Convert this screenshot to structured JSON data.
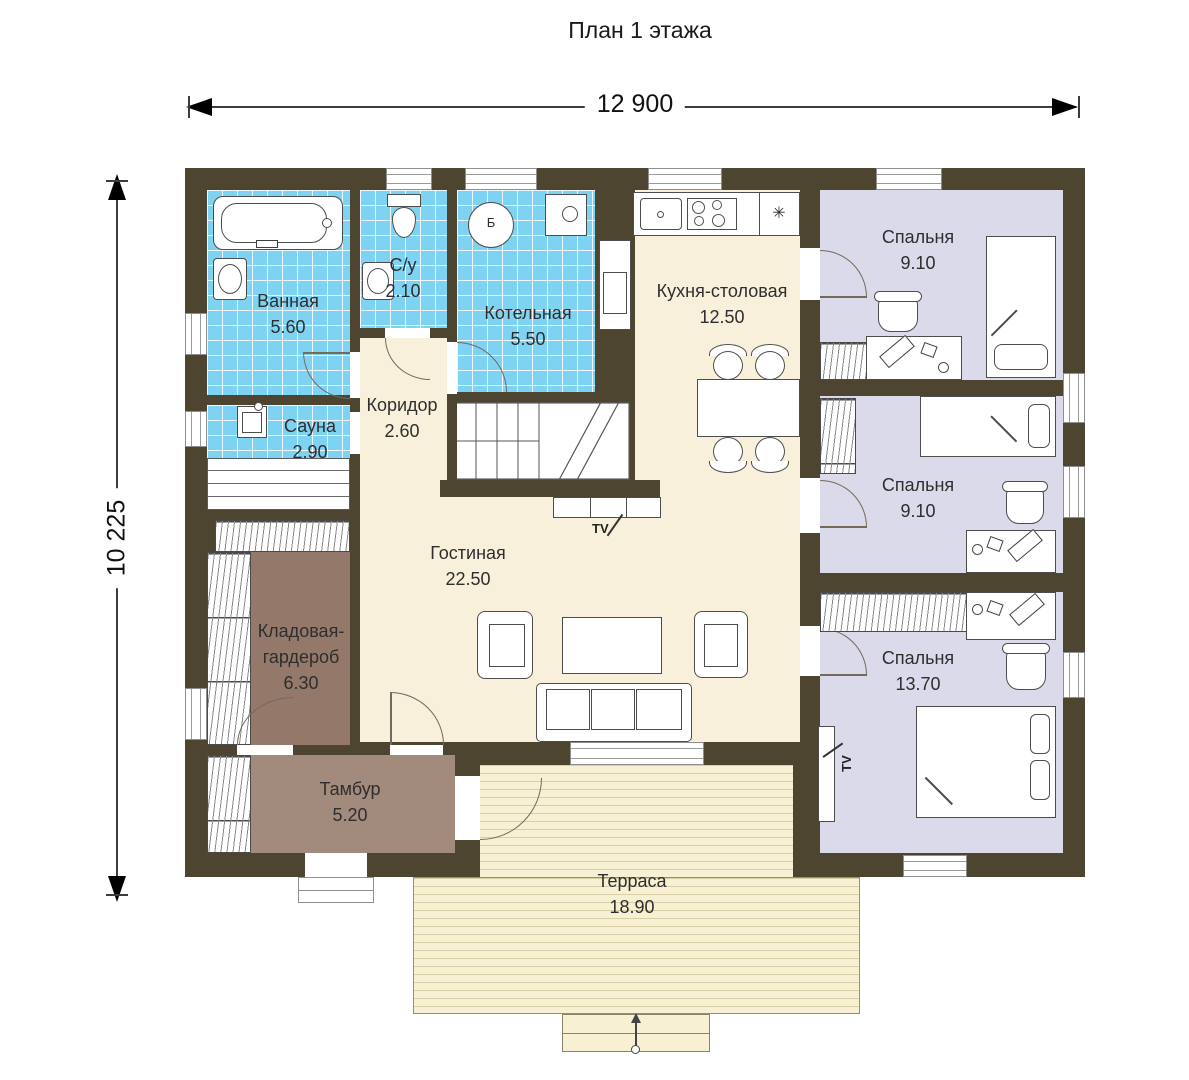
{
  "title": "План 1 этажа",
  "dimensions": {
    "width": "12 900",
    "height": "10 225"
  },
  "rooms": {
    "bathroom": {
      "name": "Ванная",
      "area": "5.60"
    },
    "wc": {
      "name": "С/у",
      "area": "2.10"
    },
    "boiler": {
      "name": "Котельная",
      "area": "5.50"
    },
    "corridor": {
      "name": "Коридор",
      "area": "2.60"
    },
    "sauna": {
      "name": "Сауна",
      "area": "2.90"
    },
    "kitchen": {
      "name": "Кухня-столовая",
      "area": "12.50"
    },
    "living": {
      "name": "Гостиная",
      "area": "22.50"
    },
    "storage": {
      "name1": "Кладовая-",
      "name2": "гардероб",
      "area": "6.30"
    },
    "tambour": {
      "name": "Тамбур",
      "area": "5.20"
    },
    "bedroom1": {
      "name": "Спальня",
      "area": "9.10"
    },
    "bedroom2": {
      "name": "Спальня",
      "area": "9.10"
    },
    "bedroom3": {
      "name": "Спальня",
      "area": "13.70"
    },
    "terrace": {
      "name": "Терраса",
      "area": "18.90"
    }
  },
  "annotations": {
    "tv_living": "TV",
    "tv_bedroom3": "TV",
    "boiler_unit": "Б",
    "fridge_symbol": "✳"
  },
  "colors": {
    "wall": "#4e4531",
    "wet_room_tile": "#7ed2f2",
    "main_cream": "#f8f0da",
    "bedroom_lavender": "#dbdaea",
    "storage_brown": "#94796a",
    "tambour_brown": "#a28b7c",
    "terrace_deck": "#f8f0d3"
  }
}
